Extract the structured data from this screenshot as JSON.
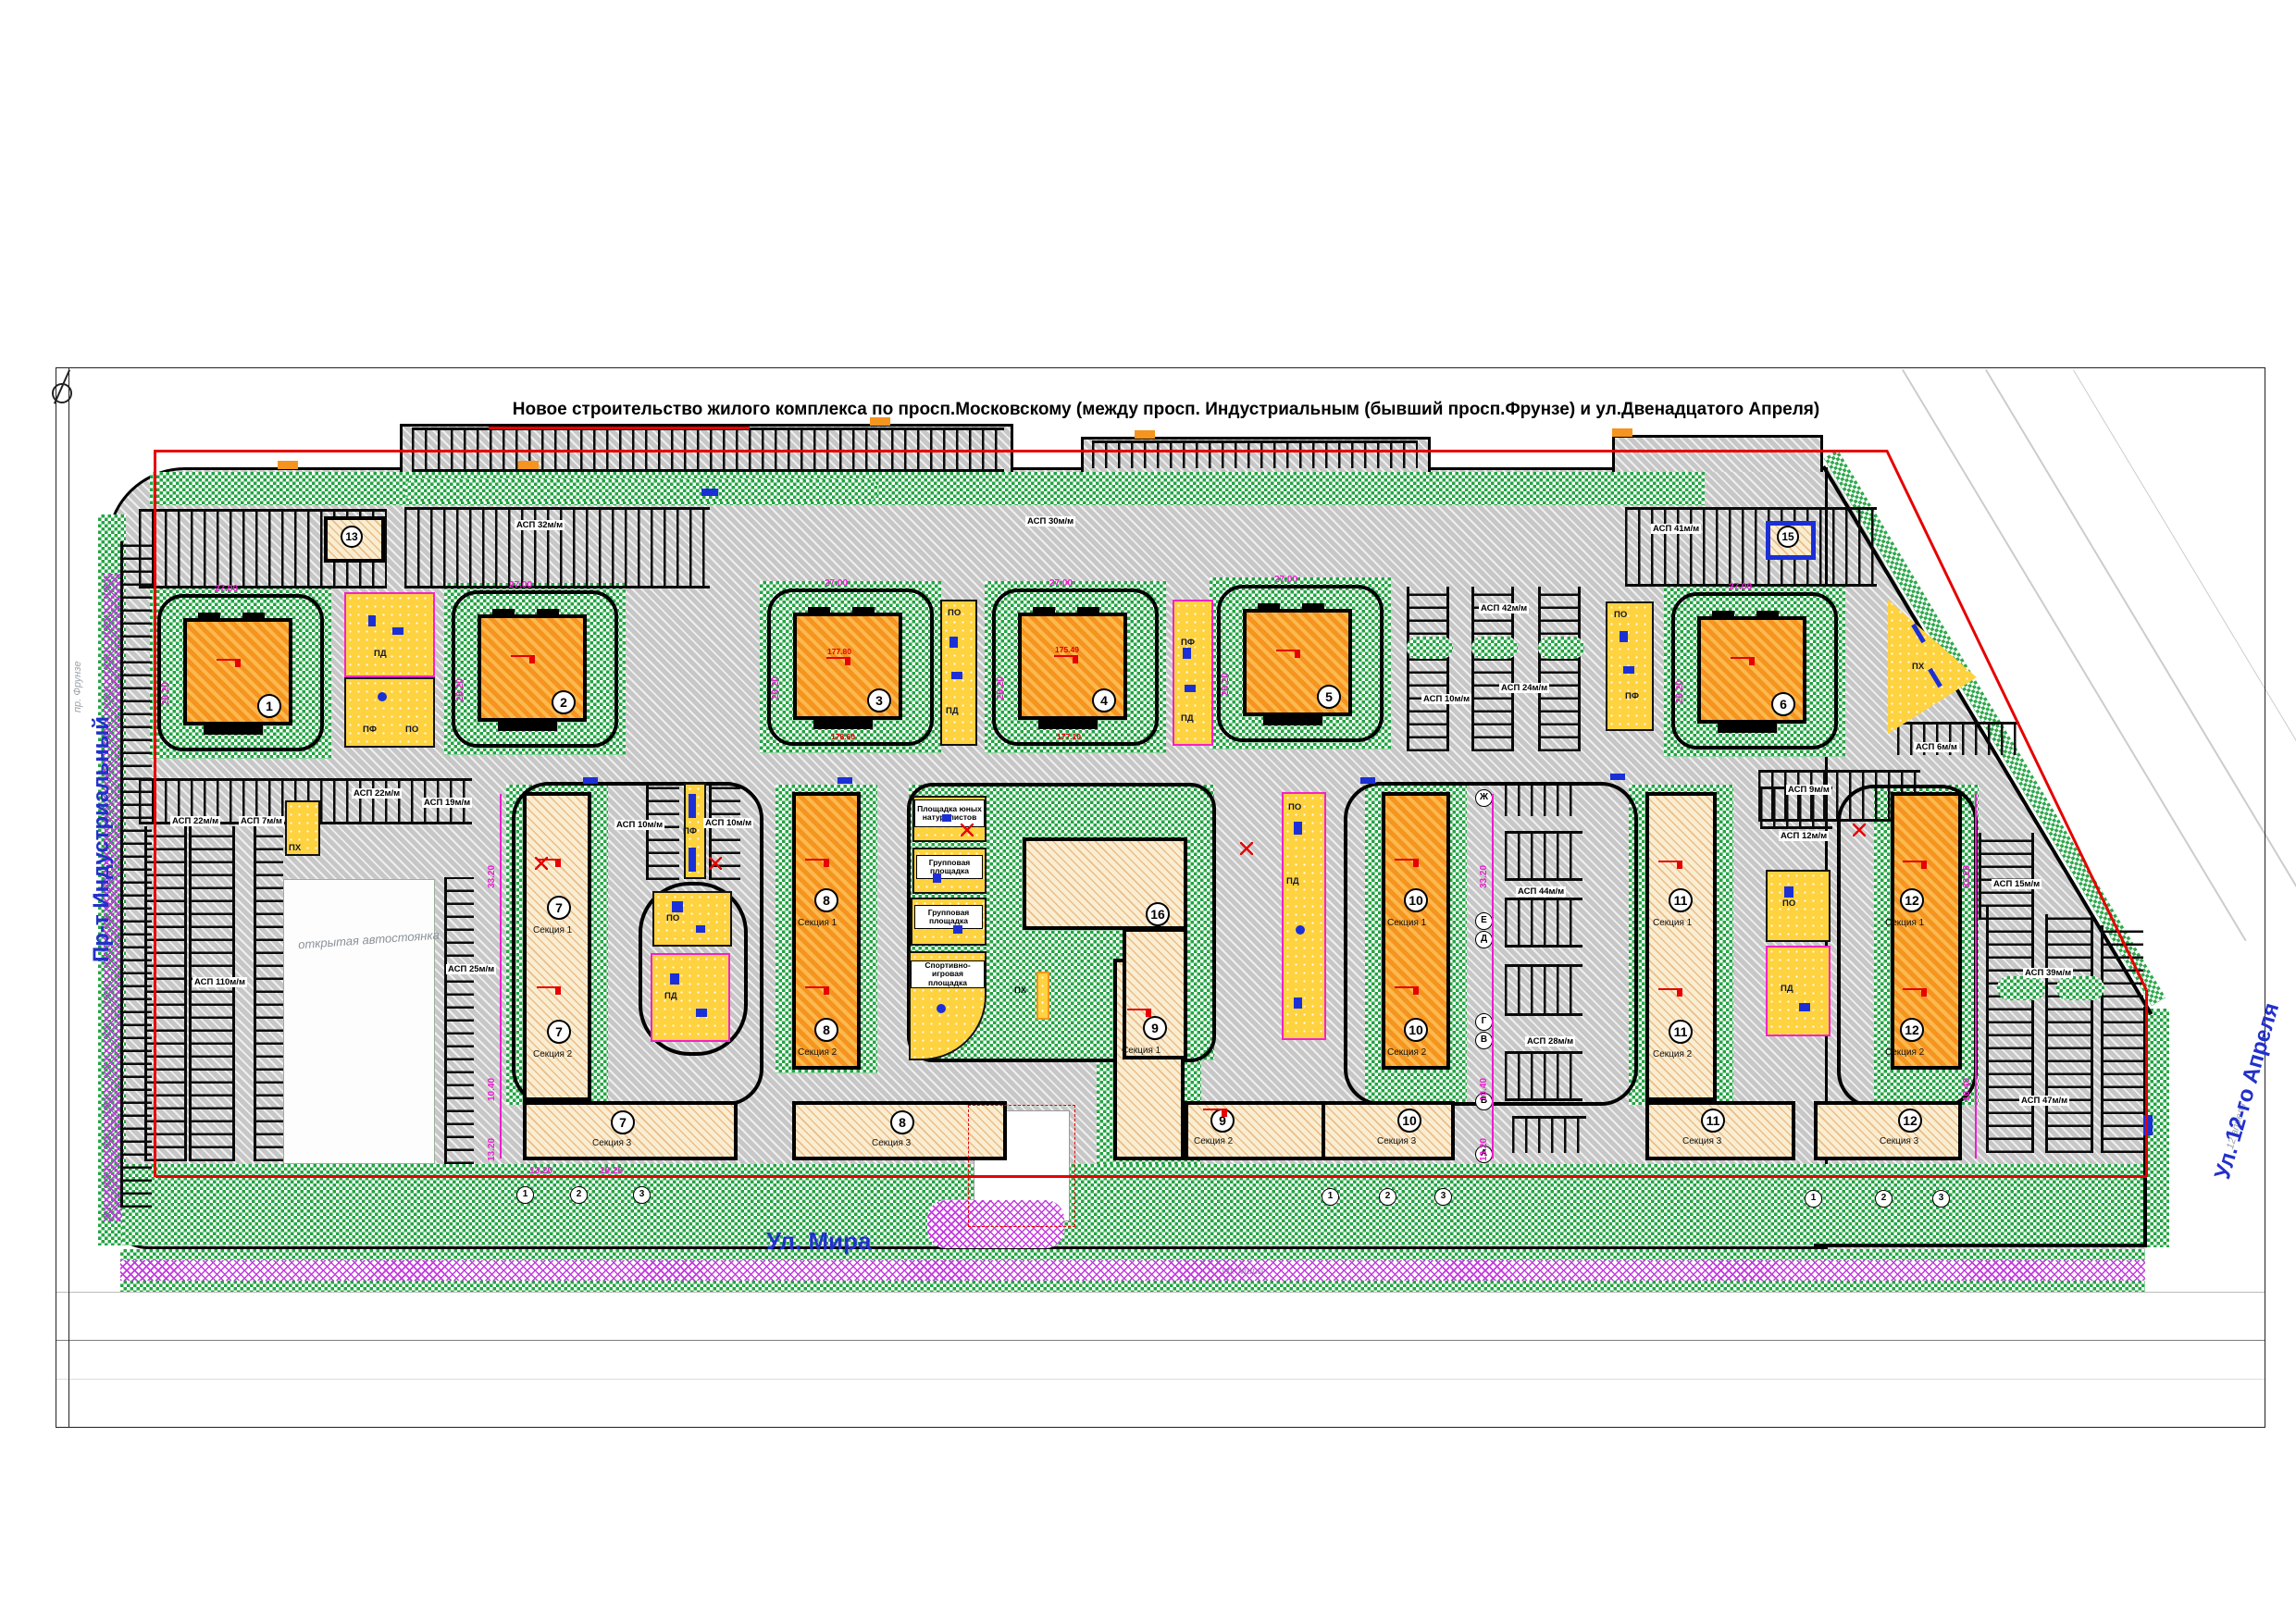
{
  "page": {
    "title": "Новое строительство жилого комплекса по просп.Московскому (между просп. Индустриальным (бывший просп.Фрунзе)   и ул.Двенадцатого Апреля)"
  },
  "streets": {
    "left": "Пр-т Индустриальный",
    "bottom": "Ул. Мира",
    "right": "Ул. 12-го Апреля"
  },
  "topo": {
    "frunze": "пр. Фрунзе",
    "mira": "ул. Мира",
    "april": "12 апреля"
  },
  "towers": [
    {
      "num": "1"
    },
    {
      "num": "2"
    },
    {
      "num": "3"
    },
    {
      "num": "4"
    },
    {
      "num": "5"
    },
    {
      "num": "6"
    }
  ],
  "slabs": [
    {
      "num": "7",
      "s1": "Секция 1",
      "s2": "Секция 2",
      "s3": "Секция 3"
    },
    {
      "num": "8",
      "s1": "Секция 1",
      "s2": "Секция 2",
      "s3": "Секция 3"
    },
    {
      "num": "9",
      "s1": "Секция 1",
      "s2": "Секция 2"
    },
    {
      "num": "10",
      "s1": "Секция 1",
      "s2": "Секция 2",
      "s3": "Секция 3"
    },
    {
      "num": "11",
      "s1": "Секция 1",
      "s2": "Секция 2",
      "s3": "Секция 3"
    },
    {
      "num": "12",
      "s1": "Секция 1",
      "s2": "Секция 2",
      "s3": "Секция 3"
    }
  ],
  "kindergarten": {
    "num": "16",
    "pg1": "Площадка юных натуралистов",
    "pg2": "Групповая площадка",
    "pg3": "Групповая площадка",
    "pg4": "Спортивно-игровая площадка"
  },
  "substations": {
    "left": "13",
    "right": "15"
  },
  "open_parking_label": "открытая автостоянка",
  "parking_labels": [
    "АСП 32м/м",
    "АСП 30м/м",
    "АСП 42м/м",
    "АСП 10м/м",
    "АСП 24м/м",
    "АСП 41м/м",
    "АСП 9м/м",
    "АСП 6м/м",
    "АСП 44м/м",
    "АСП 28м/м",
    "АСП 10м/м",
    "АСП 10м/м",
    "АСП 22м/м",
    "АСП 7м/м",
    "АСП 22м/м",
    "АСП 19м/м",
    "АСП 110м/м",
    "АСП 25м/м",
    "АСП 12м/м",
    "АСП 15м/м",
    "АСП 39м/м",
    "АСП 47м/м"
  ],
  "playground_codes": {
    "pd": "ПД",
    "po": "ПО",
    "pf": "ПФ",
    "ph": "ПХ"
  },
  "axes": {
    "letters": [
      "Ж",
      "Е",
      "Д",
      "Г",
      "В",
      "Б",
      "А"
    ],
    "numbers": [
      "1",
      "2",
      "3"
    ]
  },
  "dims": {
    "d1": "27.00",
    "d2": "26.20",
    "d3": "33.20",
    "d4": "10.40",
    "d5": "13.20",
    "d6": "16.25"
  },
  "elevations": {
    "e1": "177.80",
    "e2": "175.49",
    "e3": "178.60",
    "e4": "177.10"
  },
  "colors": {
    "green": "#23a443",
    "gray": "#c7c7c7",
    "orange": "#f5941f",
    "beige": "#f9edd2",
    "yellow": "#ffd23f",
    "magenta": "#ec1fd0",
    "purple": "#c43ae0",
    "blue": "#1b2fd6",
    "red": "#e60000",
    "street_blue": "#2230cc"
  }
}
